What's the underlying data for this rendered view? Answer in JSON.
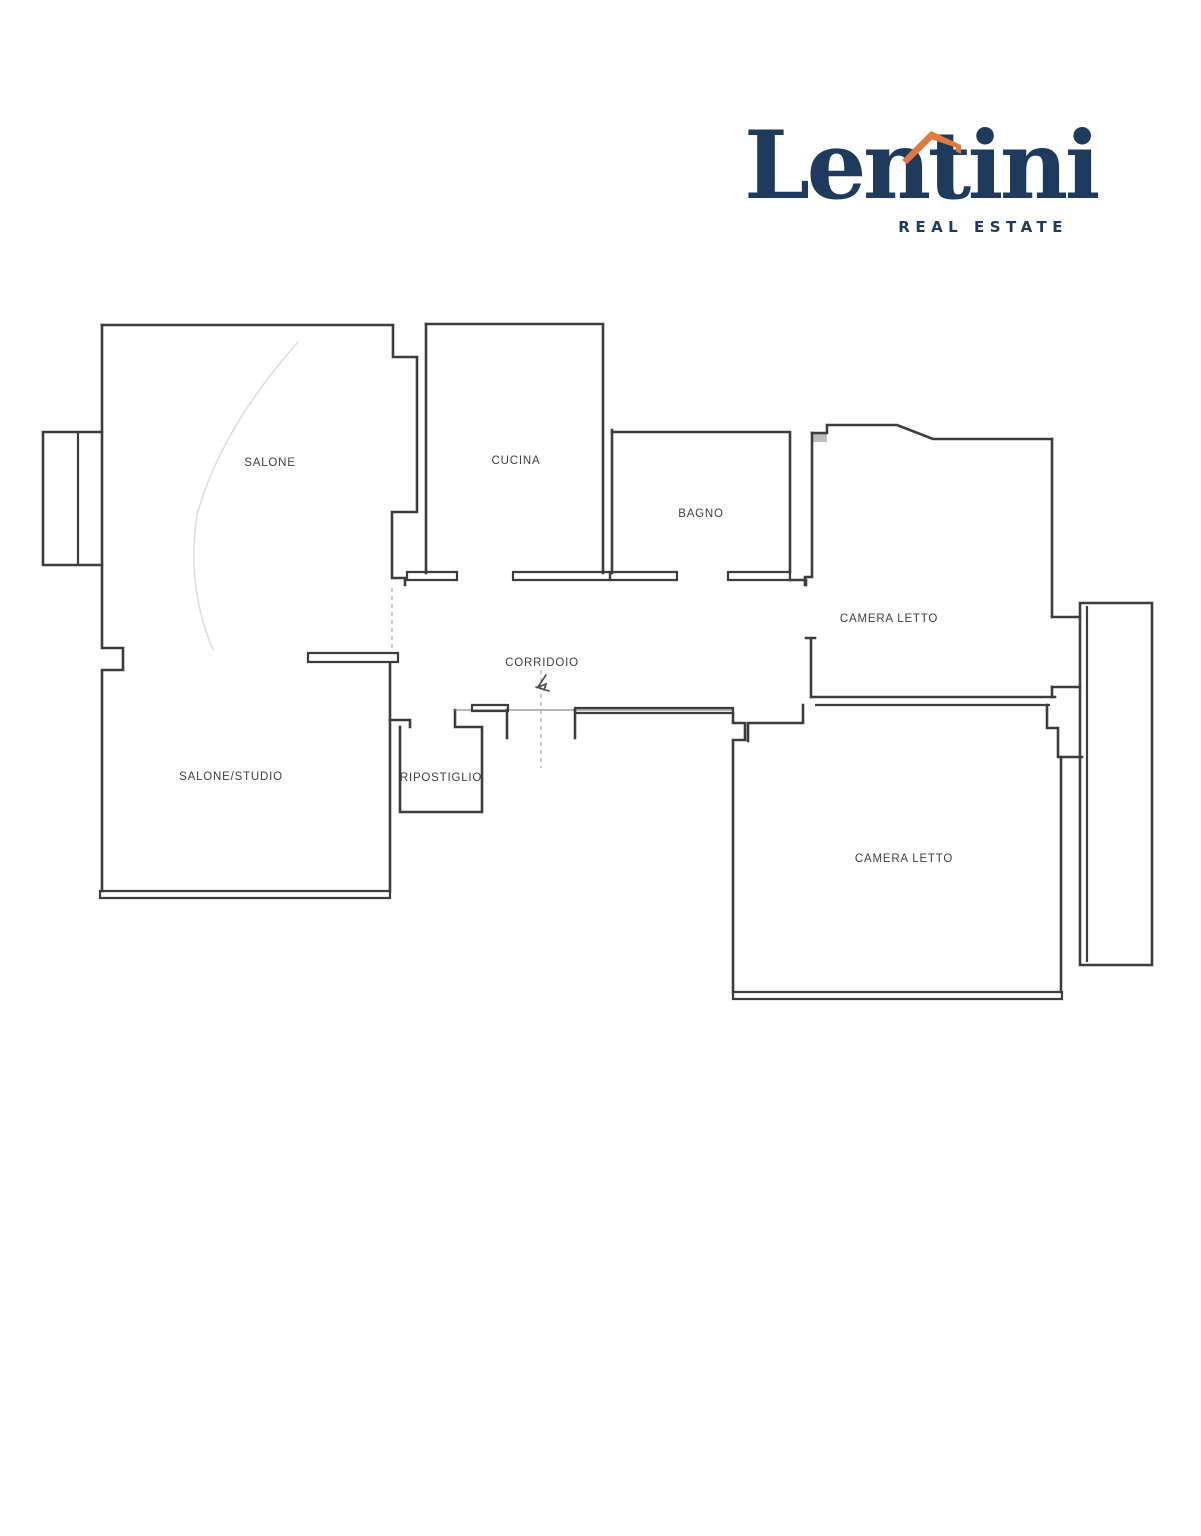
{
  "page": {
    "background": "#ffffff"
  },
  "logo": {
    "brand": "Lentini",
    "tagline": "REAL ESTATE",
    "navy": "#1e3a5c",
    "orange": "#e2793c"
  },
  "floor_plan": {
    "wall_color": "#3d3d3d",
    "rooms": [
      {
        "id": "salone",
        "label": "SALONE"
      },
      {
        "id": "cucina",
        "label": "CUCINA"
      },
      {
        "id": "bagno",
        "label": "BAGNO"
      },
      {
        "id": "camera-letto-1",
        "label": "CAMERA LETTO"
      },
      {
        "id": "corridoio",
        "label": "CORRIDOIO"
      },
      {
        "id": "salone-studio",
        "label": "SALONE/STUDIO"
      },
      {
        "id": "ripostiglio",
        "label": "RIPOSTIGLIO"
      },
      {
        "id": "camera-letto-2",
        "label": "CAMERA LETTO"
      }
    ]
  }
}
